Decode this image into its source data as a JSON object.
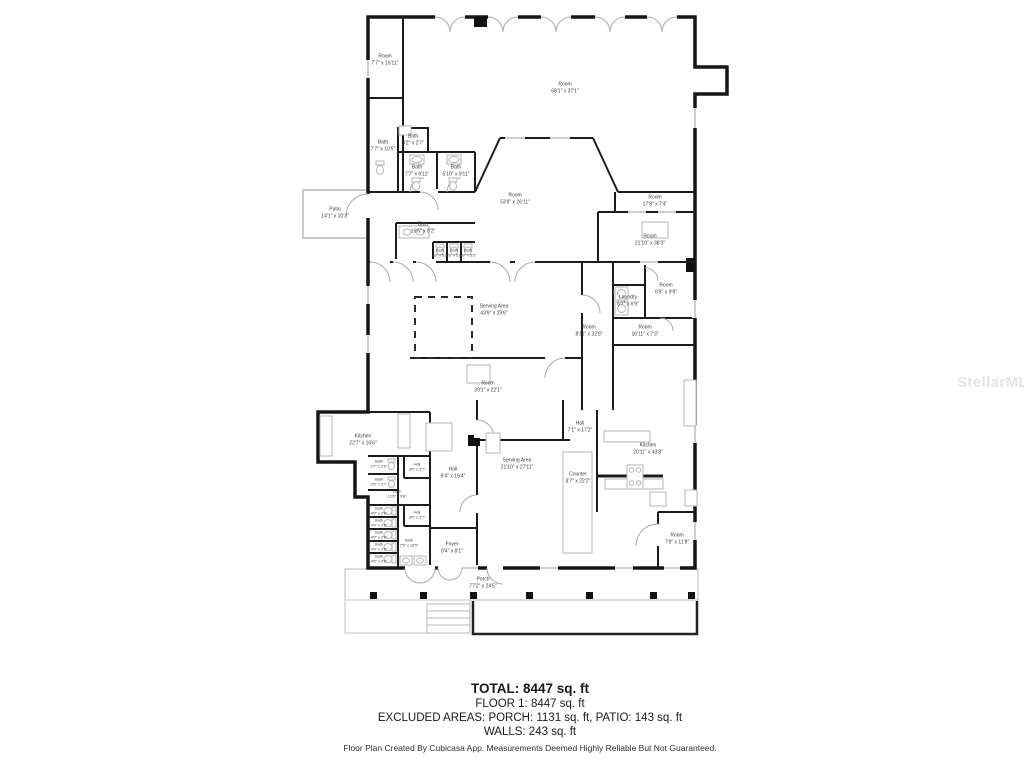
{
  "watermark": "StellarMLS",
  "summary": {
    "total": "TOTAL: 8447 sq. ft",
    "floor1": "FLOOR 1: 8447 sq. ft",
    "excluded": "EXCLUDED AREAS: PORCH: 1131 sq. ft, PATIO: 143 sq. ft",
    "walls": "WALLS: 243 sq. ft"
  },
  "disclaimer": "Floor Plan Created By Cubicasa App. Measurements Deemed Highly Reliable But Not Guaranteed.",
  "rooms": [
    {
      "name": "Room",
      "dims": "7'7\" x 16'11\"",
      "x": 385,
      "y": 60
    },
    {
      "name": "Room",
      "dims": "68'1\" x 37'1\"",
      "x": 565,
      "y": 88
    },
    {
      "name": "Bath",
      "dims": "7'7\" x 10'5\"",
      "x": 383,
      "y": 146
    },
    {
      "name": "Bath",
      "dims": "3'2\" x 2'7\"",
      "x": 413,
      "y": 140
    },
    {
      "name": "Bath",
      "dims": "7'7\" x 9'11\"",
      "x": 417,
      "y": 171
    },
    {
      "name": "Bath",
      "dims": "5'10\" x 9'11\"",
      "x": 456,
      "y": 171
    },
    {
      "name": "Patio",
      "dims": "14'1\" x 10'3\"",
      "x": 335,
      "y": 213
    },
    {
      "name": "Bath",
      "dims": "16'6\" x 8'2\"",
      "x": 423,
      "y": 228
    },
    {
      "name": "Bath",
      "dims": "2'8\" x 5'2\"",
      "x": 440,
      "y": 253,
      "small": true
    },
    {
      "name": "Bath",
      "dims": "2'8\" x 5'2\"",
      "x": 454,
      "y": 253,
      "small": true
    },
    {
      "name": "Bath",
      "dims": "2'8\" x 5'2\"",
      "x": 468,
      "y": 253,
      "small": true
    },
    {
      "name": "Room",
      "dims": "53'9\" x 26'11\"",
      "x": 515,
      "y": 199
    },
    {
      "name": "Room",
      "dims": "17'8\" x 7'4\"",
      "x": 655,
      "y": 201
    },
    {
      "name": "Room",
      "dims": "21'10\" x 38'3\"",
      "x": 650,
      "y": 240
    },
    {
      "name": "Serving Area",
      "dims": "43'9\" x 29'6\"",
      "x": 494,
      "y": 310
    },
    {
      "name": "Room",
      "dims": "6'9\" x 9'9\"",
      "x": 666,
      "y": 289
    },
    {
      "name": "Laundry",
      "dims": "6'7\" x 6'9\"",
      "x": 628,
      "y": 301
    },
    {
      "name": "Room",
      "dims": "8'11\" x 32'8\"",
      "x": 589,
      "y": 331
    },
    {
      "name": "Room",
      "dims": "16'11\" x 7'3\"",
      "x": 645,
      "y": 331
    },
    {
      "name": "Room",
      "dims": "39'1\" x 22'1\"",
      "x": 488,
      "y": 387
    },
    {
      "name": "Kitchen",
      "dims": "22'7\" x 16'6\"",
      "x": 363,
      "y": 440
    },
    {
      "name": "Hall",
      "dims": "7'1\" x 17'2\"",
      "x": 580,
      "y": 427
    },
    {
      "name": "Serving Area",
      "dims": "21'10\" x 27'11\"",
      "x": 517,
      "y": 464
    },
    {
      "name": "Counter",
      "dims": "8'7\" x 22'2\"",
      "x": 578,
      "y": 478
    },
    {
      "name": "Kitchen",
      "dims": "20'11\" x 43'8\"",
      "x": 648,
      "y": 449
    },
    {
      "name": "Hall",
      "dims": "8'4\" x 15'4\"",
      "x": 453,
      "y": 473
    },
    {
      "name": "Bath",
      "dims": "2'7\" x 2'6\"",
      "x": 379,
      "y": 464,
      "small": true
    },
    {
      "name": "Hall",
      "dims": "3'6\" x 3'7\"",
      "x": 417,
      "y": 467,
      "small": true
    },
    {
      "name": "Bath",
      "dims": "2'6\" x 2'7\"",
      "x": 379,
      "y": 482,
      "small": true
    },
    {
      "name": "Bath",
      "dims": "12'6\" x 9'8\"",
      "x": 397,
      "y": 494,
      "small": true
    },
    {
      "name": "Bath",
      "dims": "4'9\" x 2'6\"",
      "x": 379,
      "y": 511,
      "small": true
    },
    {
      "name": "Bath",
      "dims": "4'9\" x 2'6\"",
      "x": 379,
      "y": 523,
      "small": true
    },
    {
      "name": "Bath",
      "dims": "4'9\" x 2'6\"",
      "x": 379,
      "y": 535,
      "small": true
    },
    {
      "name": "Bath",
      "dims": "4'9\" x 2'6\"",
      "x": 379,
      "y": 547,
      "small": true
    },
    {
      "name": "Bath",
      "dims": "4'9\" x 2'6\"",
      "x": 379,
      "y": 559,
      "small": true
    },
    {
      "name": "Hall",
      "dims": "3'6\" x 3'7\"",
      "x": 417,
      "y": 515,
      "small": true
    },
    {
      "name": "Bath",
      "dims": "7'5\" x 13'5\"",
      "x": 409,
      "y": 543,
      "small": true
    },
    {
      "name": "Foyer",
      "dims": "8'4\" x 8'1\"",
      "x": 452,
      "y": 548
    },
    {
      "name": "Room",
      "dims": "7'9\" x 11'8\"",
      "x": 677,
      "y": 539
    },
    {
      "name": "Porch",
      "dims": "77'2\" x 24'5\"",
      "x": 483,
      "y": 583
    }
  ]
}
